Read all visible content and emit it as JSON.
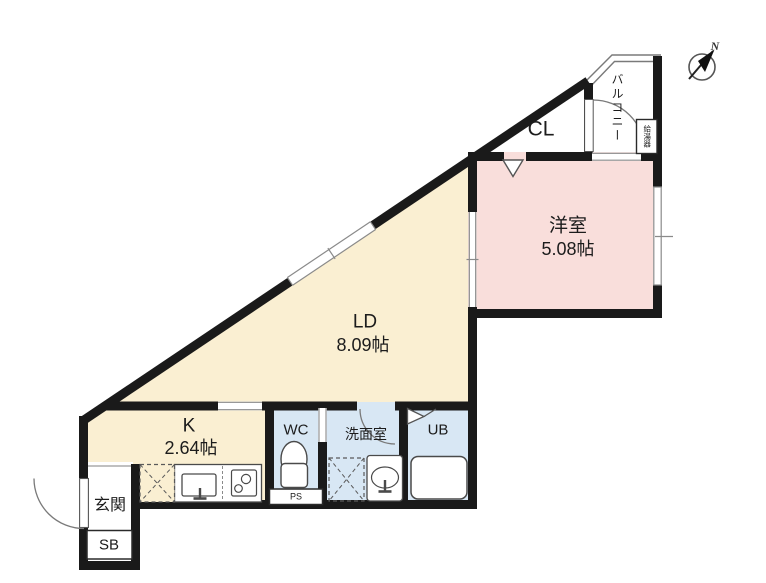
{
  "plan_type": "floor-plan",
  "rooms": {
    "ld": {
      "name": "LD",
      "size": "8.09帖"
    },
    "western": {
      "name": "洋室",
      "size": "5.08帖"
    },
    "kitchen": {
      "name": "K",
      "size": "2.64帖"
    },
    "wc": {
      "name": "WC"
    },
    "washroom": {
      "name": "洗面室"
    },
    "unit_bath": {
      "name": "UB"
    },
    "closet": {
      "name": "CL"
    },
    "balcony": {
      "name": "バルコニー"
    },
    "entrance": {
      "name": "玄関"
    },
    "shoe_box": {
      "name": "SB"
    },
    "pipe_space": {
      "name": "PS"
    },
    "water_heater": {
      "name": "給湯器"
    }
  },
  "compass": {
    "north_label": "N"
  },
  "colors": {
    "ldk_floor": "#faefd2",
    "western_room_floor": "#f9dedb",
    "wet_area_floor": "#d8e7f4",
    "wall": "#1a1a1a",
    "thin_line": "#888888",
    "background": "#ffffff"
  }
}
